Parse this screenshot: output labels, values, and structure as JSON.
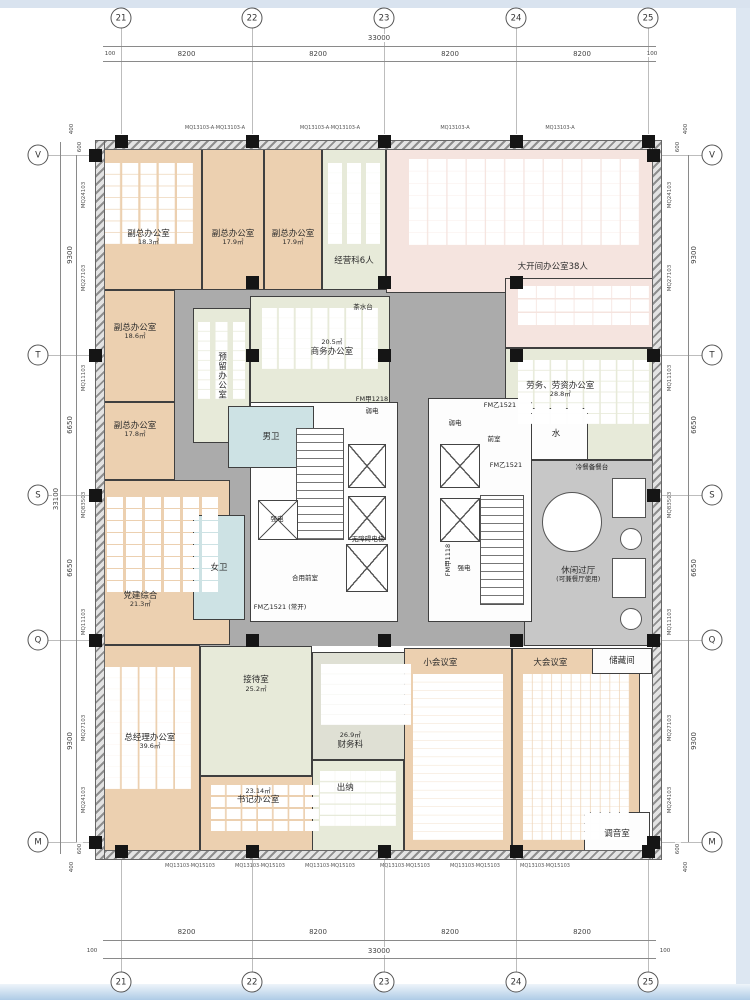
{
  "drawing": {
    "kind": "office-floor-plan"
  },
  "palette": {
    "office": "#ecd0b0",
    "meeting_green": "#e7ead9",
    "open_office_pink": "#f5e4df",
    "toilet_blue": "#cde2e4",
    "corridor_gray": "#ababab",
    "leisure_gray": "#c7c7c7",
    "finance_gray_green": "#dfe0d4",
    "wall_dark": "#151515",
    "band_blue": "#d9e3ef"
  },
  "grid": {
    "cols": [
      {
        "label": "21",
        "x": 121
      },
      {
        "label": "22",
        "x": 252
      },
      {
        "label": "23",
        "x": 384
      },
      {
        "label": "24",
        "x": 516
      },
      {
        "label": "25",
        "x": 648
      }
    ],
    "rows": [
      {
        "label": "V",
        "y": 155
      },
      {
        "label": "T",
        "y": 355
      },
      {
        "label": "S",
        "y": 495
      },
      {
        "label": "Q",
        "y": 640
      },
      {
        "label": "M",
        "y": 842
      }
    ]
  },
  "dims": {
    "top": {
      "total": "33000",
      "spans": [
        "8200",
        "8200",
        "8200",
        "8200"
      ],
      "ends": [
        "100",
        "100"
      ]
    },
    "bottom": {
      "total": "33000",
      "spans": [
        "8200",
        "8200",
        "8200",
        "8200"
      ],
      "ends": [
        "100",
        "100"
      ]
    },
    "left": {
      "total": "33100",
      "spans": [
        "9300",
        "6650",
        "6650",
        "9300"
      ],
      "extras": [
        "400",
        "600",
        "600",
        "400"
      ]
    },
    "right": {
      "spans": [
        "9300",
        "6650",
        "6650",
        "9300"
      ],
      "extras": [
        "400",
        "600",
        "600",
        "400"
      ]
    }
  },
  "mullions": {
    "left": [
      "MQ24103",
      "MQ27103",
      "MQ11103",
      "MQ83503",
      "MQ11103",
      "MQ27103",
      "MQ24103"
    ],
    "right": [
      "MQ24103",
      "MQ27103",
      "MQ11103",
      "MQ83503",
      "MQ11103",
      "MQ27103",
      "MQ24103"
    ],
    "top": [
      "MQ13103-A·MQ13103-A",
      "MQ13103-A·MQ13103-A",
      "MQ13103-A",
      "MQ13103-A"
    ],
    "bottom": [
      "MQ13103·MQ15103",
      "MQ13103·MQ15103",
      "MQ13103·MQ15103",
      "MQ13103·MQ15103",
      "MQ13103·MQ15103",
      "MQ13103·MQ15103"
    ]
  },
  "zones": [
    {
      "cls": "hall",
      "x": 175,
      "y": 278,
      "w": 351,
      "h": 368
    },
    {
      "cls": "hall",
      "x": 505,
      "y": 588,
      "w": 157,
      "h": 58
    }
  ],
  "rooms": [
    {
      "name": "副总办公室",
      "area": "18.3㎡",
      "cls": "office",
      "x": 95,
      "y": 148,
      "w": 107,
      "h": 142,
      "furn": [
        16,
        11
      ],
      "ly": 238
    },
    {
      "name": "副总办公室",
      "area": "17.9㎡",
      "cls": "office",
      "x": 202,
      "y": 148,
      "w": 62,
      "h": 142,
      "ly": 238
    },
    {
      "name": "副总办公室",
      "area": "17.9㎡",
      "cls": "office",
      "x": 264,
      "y": 148,
      "w": 58,
      "h": 142,
      "ly": 238
    },
    {
      "name": "经营科6人",
      "area": "",
      "cls": "green",
      "x": 322,
      "y": 148,
      "w": 64,
      "h": 142,
      "furn": [
        14,
        10
      ],
      "ly": 262
    },
    {
      "name": "大开间办公室38人",
      "area": "",
      "cls": "open",
      "x": 386,
      "y": 143,
      "w": 276,
      "h": 150,
      "furn": [
        18,
        12
      ],
      "lx": 553,
      "ly": 268
    },
    {
      "name": "",
      "area": "",
      "cls": "open",
      "x": 505,
      "y": 278,
      "w": 157,
      "h": 70,
      "furn": [
        18,
        12
      ]
    },
    {
      "name": "副总办公室",
      "area": "18.6㎡",
      "cls": "office",
      "x": 95,
      "y": 290,
      "w": 80,
      "h": 112,
      "ly": 332
    },
    {
      "name": "副总办公室",
      "area": "17.8㎡",
      "cls": "office",
      "x": 95,
      "y": 402,
      "w": 80,
      "h": 78,
      "ly": 430
    },
    {
      "name": "预留办公室",
      "area": "",
      "cls": "green",
      "x": 193,
      "y": 308,
      "w": 57,
      "h": 135,
      "vert": true,
      "furn": [
        12,
        9
      ]
    },
    {
      "name": "商务办公室",
      "area": "20.5㎡",
      "cls": "green",
      "x": 250,
      "y": 296,
      "w": 140,
      "h": 108,
      "furn": [
        15,
        10
      ],
      "lx": 332,
      "ly": 348,
      "areaFirst": true
    },
    {
      "name": "劳务、劳资办公室",
      "area": "28.8㎡",
      "cls": "green",
      "x": 505,
      "y": 348,
      "w": 157,
      "h": 112,
      "furn": [
        15,
        10
      ],
      "lx": 560,
      "ly": 390
    },
    {
      "name": "水",
      "area": "",
      "cls": "plain",
      "x": 524,
      "y": 408,
      "w": 64,
      "h": 52
    },
    {
      "name": "休闲过厅",
      "area": "(可兼餐厅使用)",
      "cls": "hall2",
      "x": 524,
      "y": 460,
      "w": 138,
      "h": 186,
      "lx": 578,
      "ly": 575
    },
    {
      "name": "党建综合",
      "area": "21.3㎡",
      "cls": "office",
      "x": 95,
      "y": 480,
      "w": 135,
      "h": 165,
      "furn": [
        16,
        11
      ],
      "lx": 140,
      "ly": 600
    },
    {
      "name": "",
      "area": "",
      "cls": "plain",
      "x": 250,
      "y": 402,
      "w": 148,
      "h": 220
    },
    {
      "name": "",
      "area": "",
      "cls": "plain",
      "x": 428,
      "y": 398,
      "w": 104,
      "h": 224
    },
    {
      "name": "男卫",
      "area": "",
      "cls": "wet",
      "x": 228,
      "y": 406,
      "w": 86,
      "h": 62
    },
    {
      "name": "女卫",
      "area": "",
      "cls": "wet",
      "x": 193,
      "y": 515,
      "w": 52,
      "h": 105
    },
    {
      "name": "总经理办公室",
      "area": "39.6㎡",
      "cls": "office",
      "x": 95,
      "y": 645,
      "w": 105,
      "h": 213,
      "furn": [
        16,
        11
      ],
      "lx": 150,
      "ly": 742
    },
    {
      "name": "接待室",
      "area": "25.2㎡",
      "cls": "green",
      "x": 200,
      "y": 646,
      "w": 112,
      "h": 130,
      "lx": 256,
      "ly": 684
    },
    {
      "name": "书记办公室",
      "area": "23.14㎡",
      "cls": "office",
      "x": 200,
      "y": 776,
      "w": 130,
      "h": 82,
      "furn": [
        14,
        10
      ],
      "lx": 258,
      "ly": 796,
      "areaFirst": true
    },
    {
      "name": "财务科",
      "area": "26.9㎡",
      "cls": "finance",
      "x": 312,
      "y": 652,
      "w": 108,
      "h": 108,
      "furn": [
        15,
        10
      ],
      "lx": 350,
      "ly": 742,
      "areaFirst": true
    },
    {
      "name": "出纳",
      "area": "",
      "cls": "green",
      "x": 312,
      "y": 760,
      "w": 92,
      "h": 98,
      "furn": [
        15,
        10
      ],
      "lx": 345,
      "ly": 788
    },
    {
      "name": "小会议室",
      "area": "",
      "cls": "conf",
      "x": 404,
      "y": 648,
      "w": 108,
      "h": 210,
      "rows": true,
      "lx": 440,
      "ly": 662
    },
    {
      "name": "大会议室",
      "area": "",
      "cls": "conf",
      "x": 512,
      "y": 648,
      "w": 128,
      "h": 210,
      "rows": true,
      "lx": 550,
      "ly": 662
    },
    {
      "name": "储藏间",
      "area": "",
      "cls": "plain",
      "x": 592,
      "y": 648,
      "w": 60,
      "h": 26
    },
    {
      "name": "调音室",
      "area": "",
      "cls": "plain",
      "x": 584,
      "y": 812,
      "w": 66,
      "h": 44
    }
  ],
  "core_labels": [
    {
      "t": "茶水台",
      "x": 363,
      "y": 306
    },
    {
      "t": "FM甲1218",
      "x": 372,
      "y": 398
    },
    {
      "t": "弱电",
      "x": 372,
      "y": 410
    },
    {
      "t": "弱电",
      "x": 455,
      "y": 422
    },
    {
      "t": "前室",
      "x": 494,
      "y": 438
    },
    {
      "t": "FM乙1521",
      "x": 500,
      "y": 404
    },
    {
      "t": "FM乙1521",
      "x": 506,
      "y": 464
    },
    {
      "t": "强电",
      "x": 277,
      "y": 518
    },
    {
      "t": "强电",
      "x": 464,
      "y": 567
    },
    {
      "t": "合用前室",
      "x": 305,
      "y": 577
    },
    {
      "t": "无障碍电梯",
      "x": 368,
      "y": 538
    },
    {
      "t": "FM乙1521 (常开)",
      "x": 280,
      "y": 606
    },
    {
      "t": "FM甲1118",
      "x": 447,
      "y": 560,
      "vert": true
    },
    {
      "t": "冷餐备餐台",
      "x": 592,
      "y": 466
    }
  ],
  "stairs": [
    {
      "x": 296,
      "y": 428,
      "w": 48,
      "h": 112
    },
    {
      "x": 480,
      "y": 495,
      "w": 44,
      "h": 110
    }
  ],
  "xboxes": [
    {
      "x": 348,
      "y": 444,
      "w": 38,
      "h": 44
    },
    {
      "x": 348,
      "y": 496,
      "w": 38,
      "h": 44
    },
    {
      "x": 346,
      "y": 544,
      "w": 42,
      "h": 48
    },
    {
      "x": 440,
      "y": 444,
      "w": 40,
      "h": 44
    },
    {
      "x": 440,
      "y": 498,
      "w": 40,
      "h": 44
    },
    {
      "x": 258,
      "y": 500,
      "w": 40,
      "h": 40
    }
  ],
  "shapes": [
    {
      "type": "circle",
      "x": 542,
      "y": 492,
      "d": 60
    },
    {
      "type": "rect",
      "x": 612,
      "y": 478,
      "w": 34,
      "h": 40
    },
    {
      "type": "circle",
      "x": 620,
      "y": 528,
      "d": 22
    },
    {
      "type": "rect",
      "x": 612,
      "y": 558,
      "w": 34,
      "h": 40
    },
    {
      "type": "circle",
      "x": 620,
      "y": 608,
      "d": 22
    }
  ],
  "walls": [
    {
      "x": 95,
      "y": 140,
      "w": 567,
      "h": 10
    },
    {
      "x": 95,
      "y": 850,
      "w": 567,
      "h": 10
    },
    {
      "x": 95,
      "y": 140,
      "w": 10,
      "h": 720
    },
    {
      "x": 652,
      "y": 140,
      "w": 10,
      "h": 720
    }
  ],
  "columns": [
    [
      115,
      135
    ],
    [
      246,
      135
    ],
    [
      378,
      135
    ],
    [
      510,
      135
    ],
    [
      642,
      135
    ],
    [
      115,
      845
    ],
    [
      246,
      845
    ],
    [
      378,
      845
    ],
    [
      510,
      845
    ],
    [
      642,
      845
    ],
    [
      89,
      149
    ],
    [
      89,
      349
    ],
    [
      89,
      489
    ],
    [
      89,
      634
    ],
    [
      89,
      836
    ],
    [
      647,
      149
    ],
    [
      647,
      349
    ],
    [
      647,
      489
    ],
    [
      647,
      634
    ],
    [
      647,
      836
    ],
    [
      246,
      349
    ],
    [
      378,
      349
    ],
    [
      510,
      349
    ],
    [
      246,
      634
    ],
    [
      378,
      634
    ],
    [
      510,
      634
    ],
    [
      246,
      276
    ],
    [
      378,
      276
    ],
    [
      510,
      276
    ]
  ]
}
